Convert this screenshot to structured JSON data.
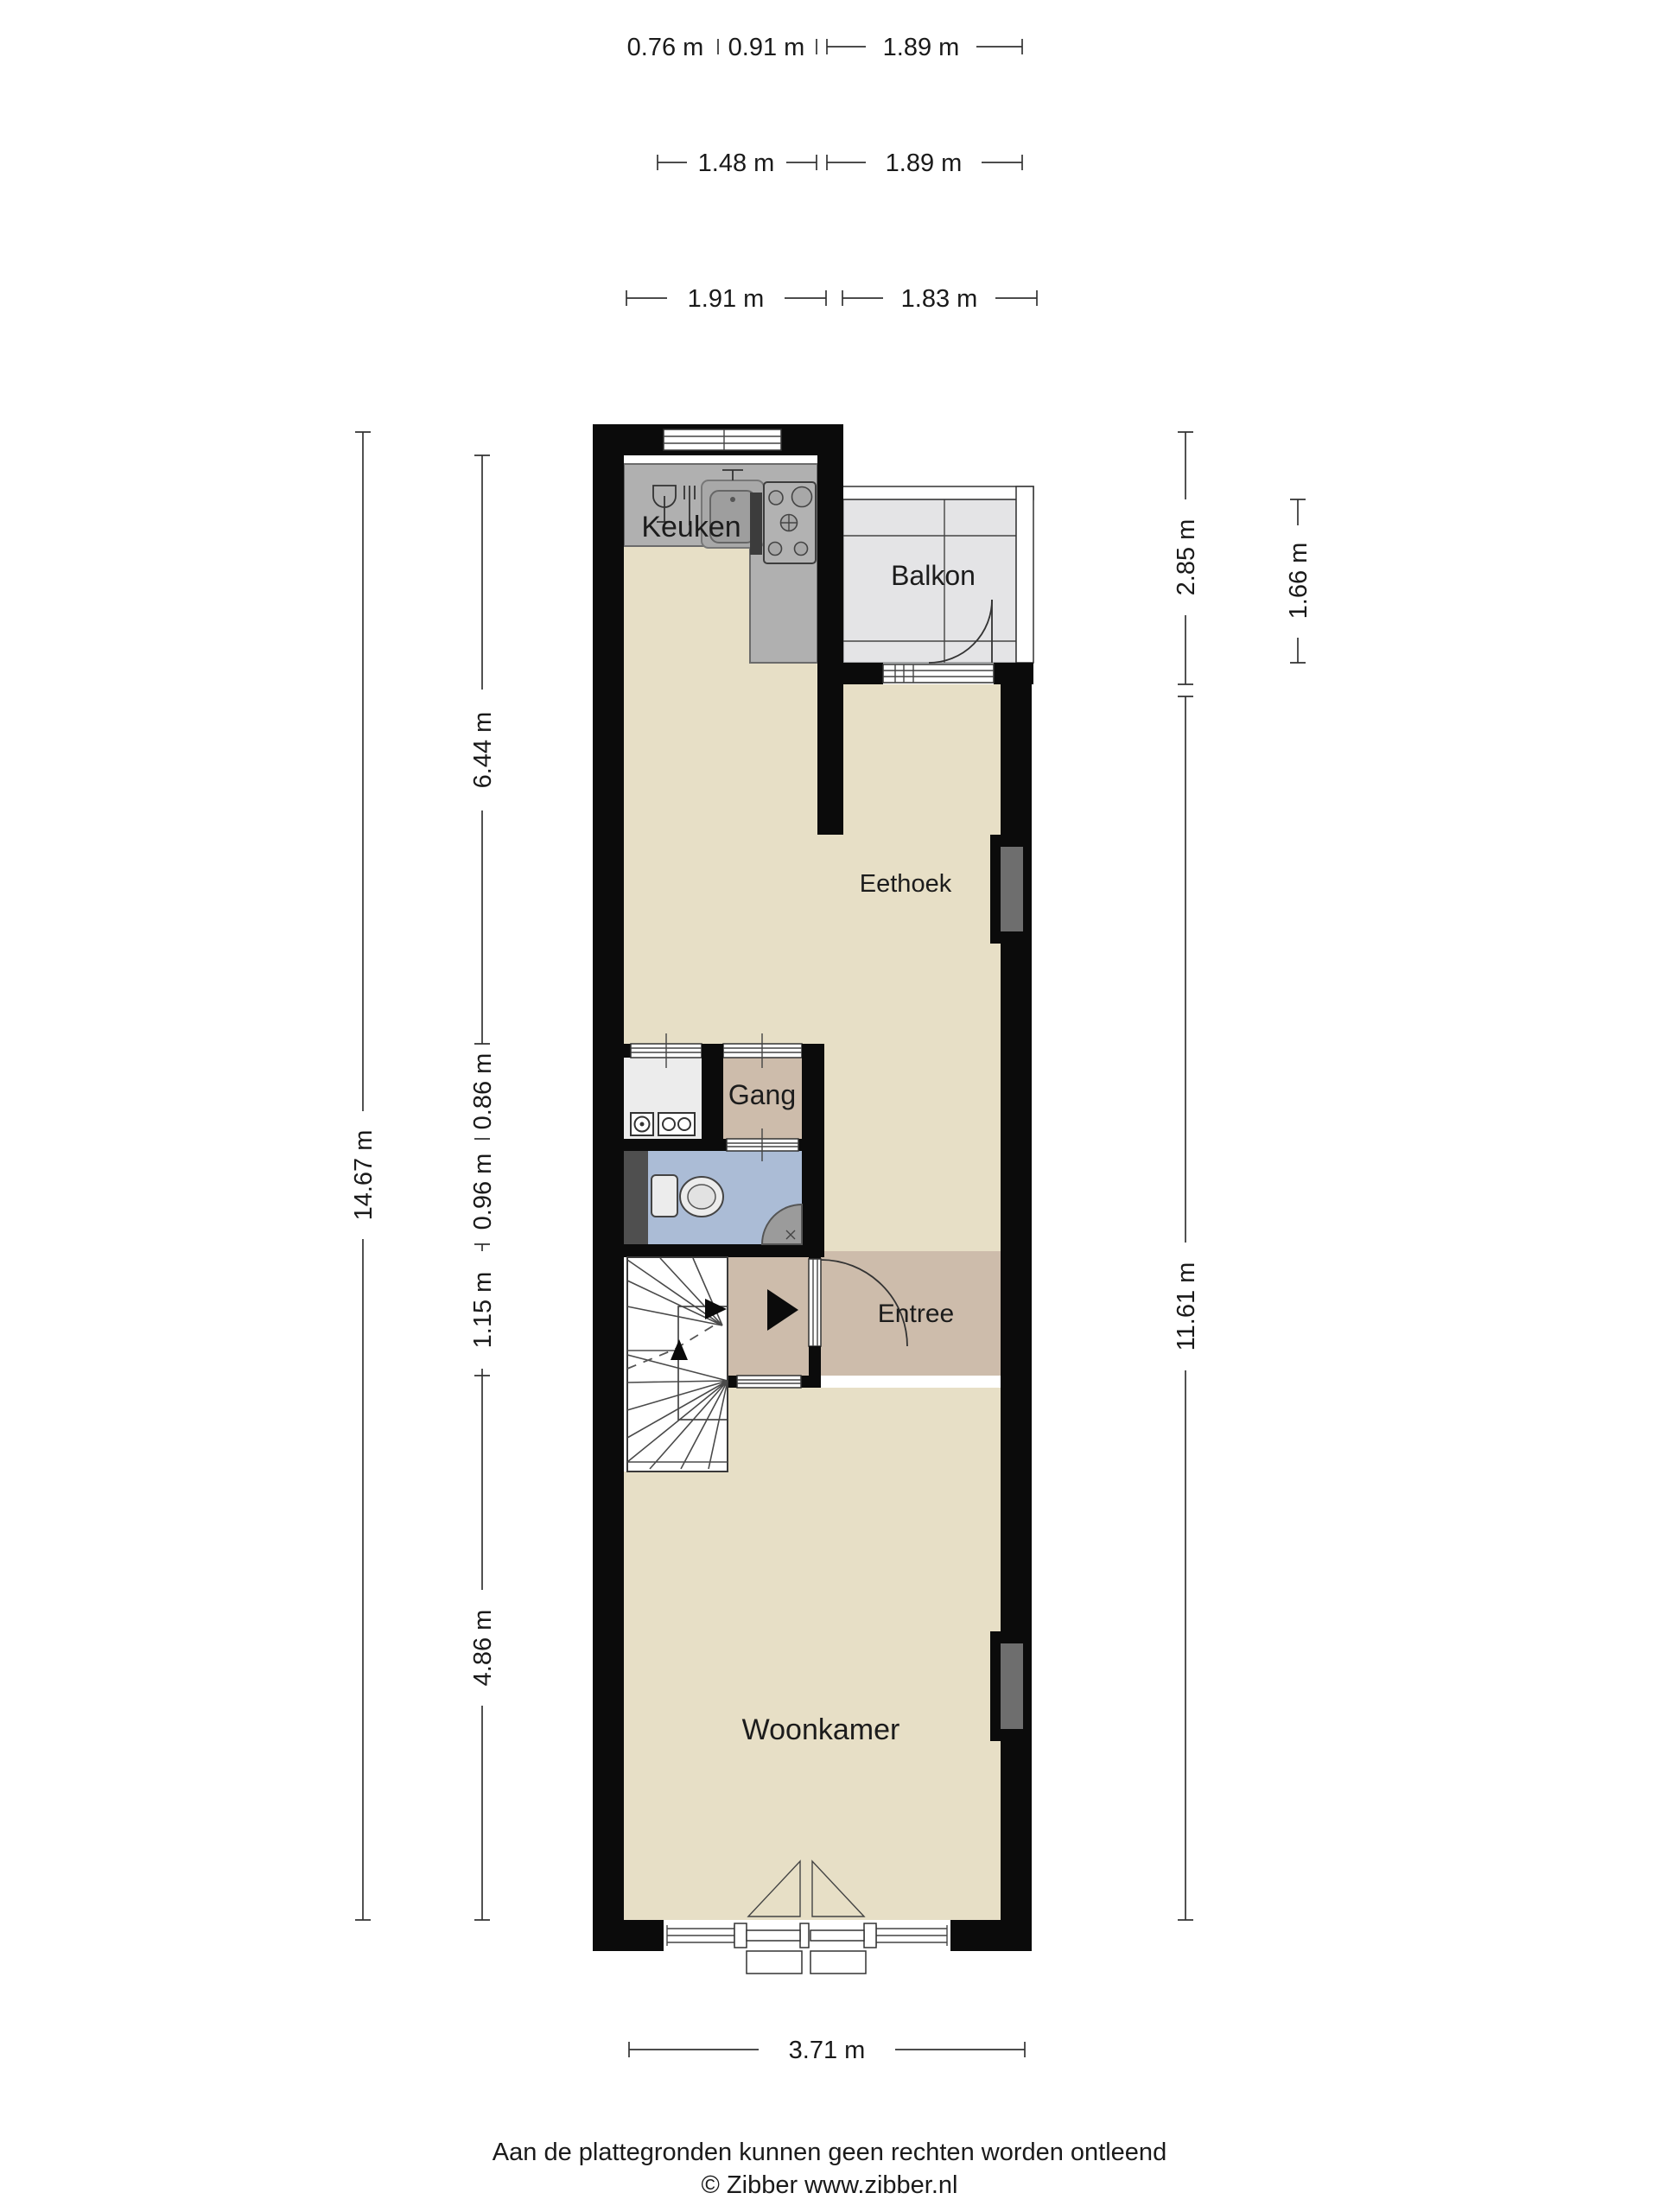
{
  "floorplan": {
    "type": "floor-plan",
    "rooms": {
      "keuken": "Keuken",
      "balkon": "Balkon",
      "eethoek": "Eethoek",
      "gang": "Gang",
      "entree": "Entree",
      "woonkamer": "Woonkamer"
    },
    "dimensions": {
      "top_row1": [
        "0.76 m",
        "0.91 m",
        "1.89 m"
      ],
      "top_row2": [
        "1.48 m",
        "1.89 m"
      ],
      "top_row3": [
        "1.91 m",
        "1.83 m"
      ],
      "left_outer": "14.67 m",
      "left_inner": [
        "6.44 m",
        "0.86 m",
        "0.96 m",
        "1.15 m",
        "4.86 m"
      ],
      "right_outer": [
        "2.85 m",
        "11.61 m"
      ],
      "balcony_depth": "1.66 m",
      "bottom": "3.71 m"
    },
    "icons": [
      "dishwasher-icon",
      "sink-icon",
      "stove-icon",
      "electric-meter-icon",
      "fuse-box-icon",
      "toilet-icon",
      "corner-basin-icon",
      "stair-direction-arrow-icon",
      "entry-direction-arrow-icon",
      "door-swing-arc",
      "window-glyph"
    ],
    "colors": {
      "wall": "#0b0b0b",
      "floor": "#e7dfc6",
      "floor_entree": "#cdbcab",
      "counter": "#b0b0b0",
      "balcony": "#e4e4e6",
      "meter_closet": "#ececec",
      "wc": "#abbcd6",
      "duct": "#4f4f4f",
      "fireplace": "#6e6e6e"
    },
    "footer": {
      "disclaimer": "Aan de plattegronden kunnen geen rechten worden ontleend",
      "copyright": "© Zibber www.zibber.nl"
    }
  }
}
